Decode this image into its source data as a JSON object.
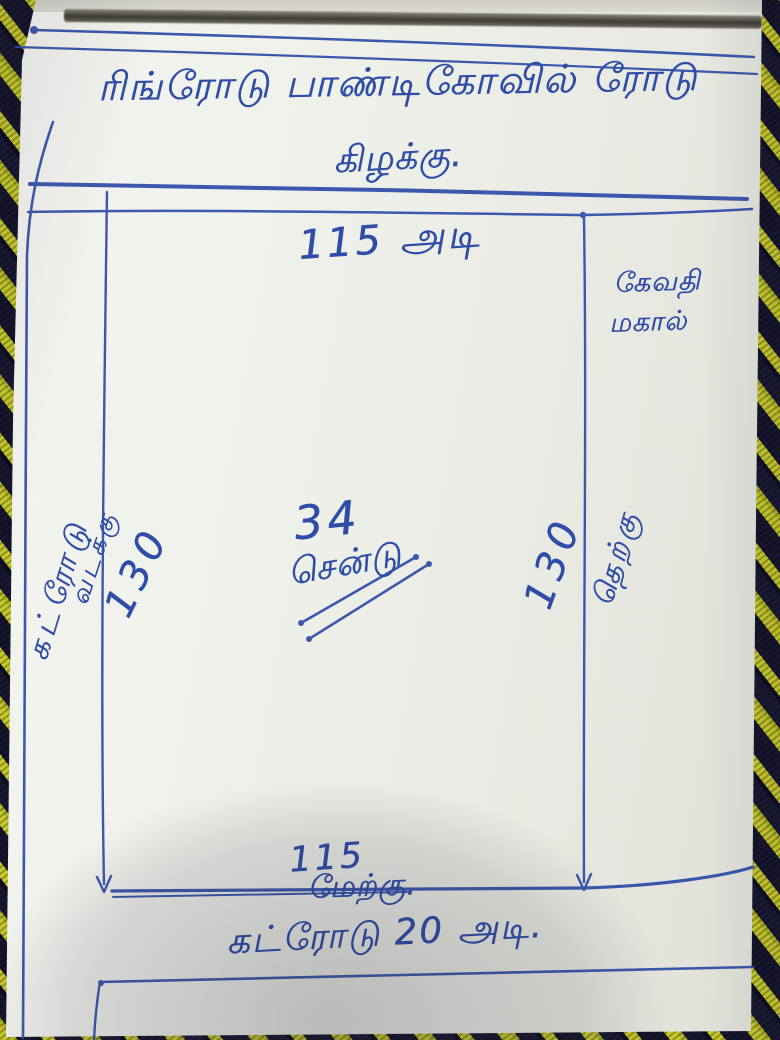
{
  "sketch": {
    "title": "ரிங்ரோடு பாண்டிகோவில் ரோடு",
    "directions": {
      "east": "கிழக்கு.",
      "north": "வடக்கு",
      "south": "தெற்கு",
      "west": "மேற்கு."
    },
    "dimensions": {
      "top": "115 அடி",
      "left": "130",
      "right": "130",
      "bottom": "115"
    },
    "area": {
      "value": "34",
      "unit": "சென்டு"
    },
    "roads": {
      "left": "கட்ரோடு",
      "bottom": "கட்ரோடு 20 அடி."
    },
    "neighbor": {
      "line1": "கேவதி",
      "line2": "மகால்"
    }
  },
  "colors": {
    "ink": "#2f4da8",
    "paper": "#eef0ea",
    "fabric_yellow": "#c9ca2b",
    "fabric_dark": "#15152e"
  }
}
